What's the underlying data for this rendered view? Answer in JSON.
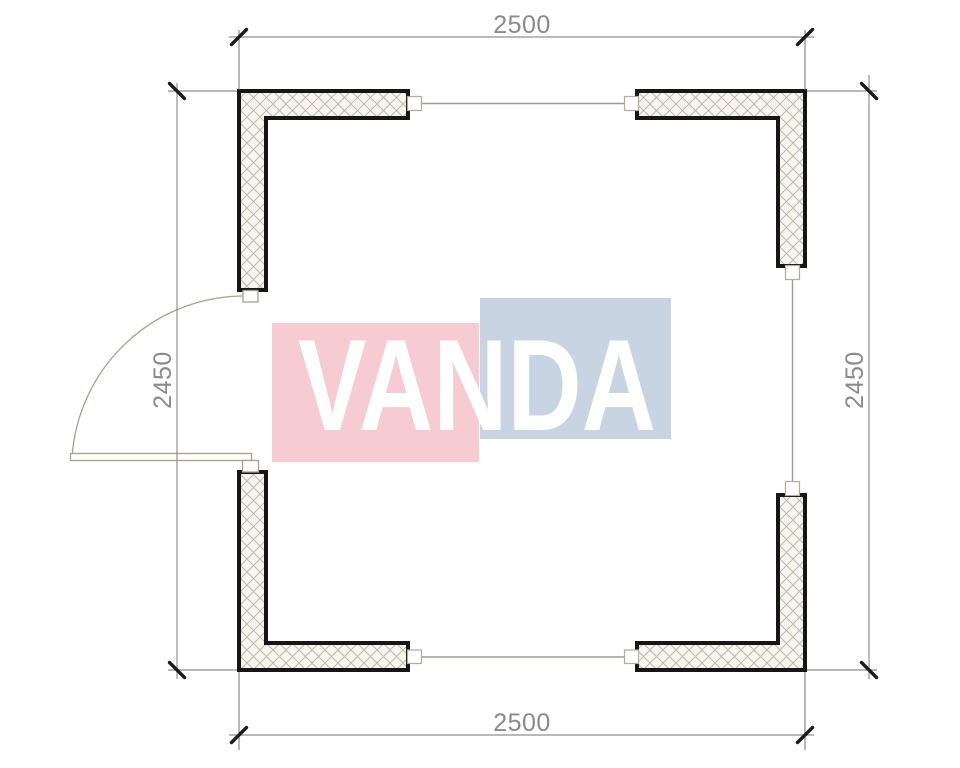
{
  "page": {
    "background_color": "#ffffff",
    "content_type": "architectural floor plan"
  },
  "dimensions": {
    "top": "2500",
    "bottom": "2500",
    "left": "2450",
    "right": "2450"
  },
  "watermark": {
    "brand_text": "VANDA",
    "text_color": "#ffffff",
    "pink_block_color": "#f7cbd2",
    "blue_block_color": "#c8d4e2"
  },
  "colors": {
    "wall_outline": "#161616",
    "wall_fill": "#f7f5ef",
    "hatch_line": "#c0b8a8",
    "dim_line": "#8f8f8f",
    "ext_line": "#707070",
    "tick": "#1c1c1c",
    "dim_text": "#8a8a8a",
    "door": "#a8a08a",
    "window_line": "#9c9c97",
    "stub_stroke": "#b3ac9c"
  }
}
